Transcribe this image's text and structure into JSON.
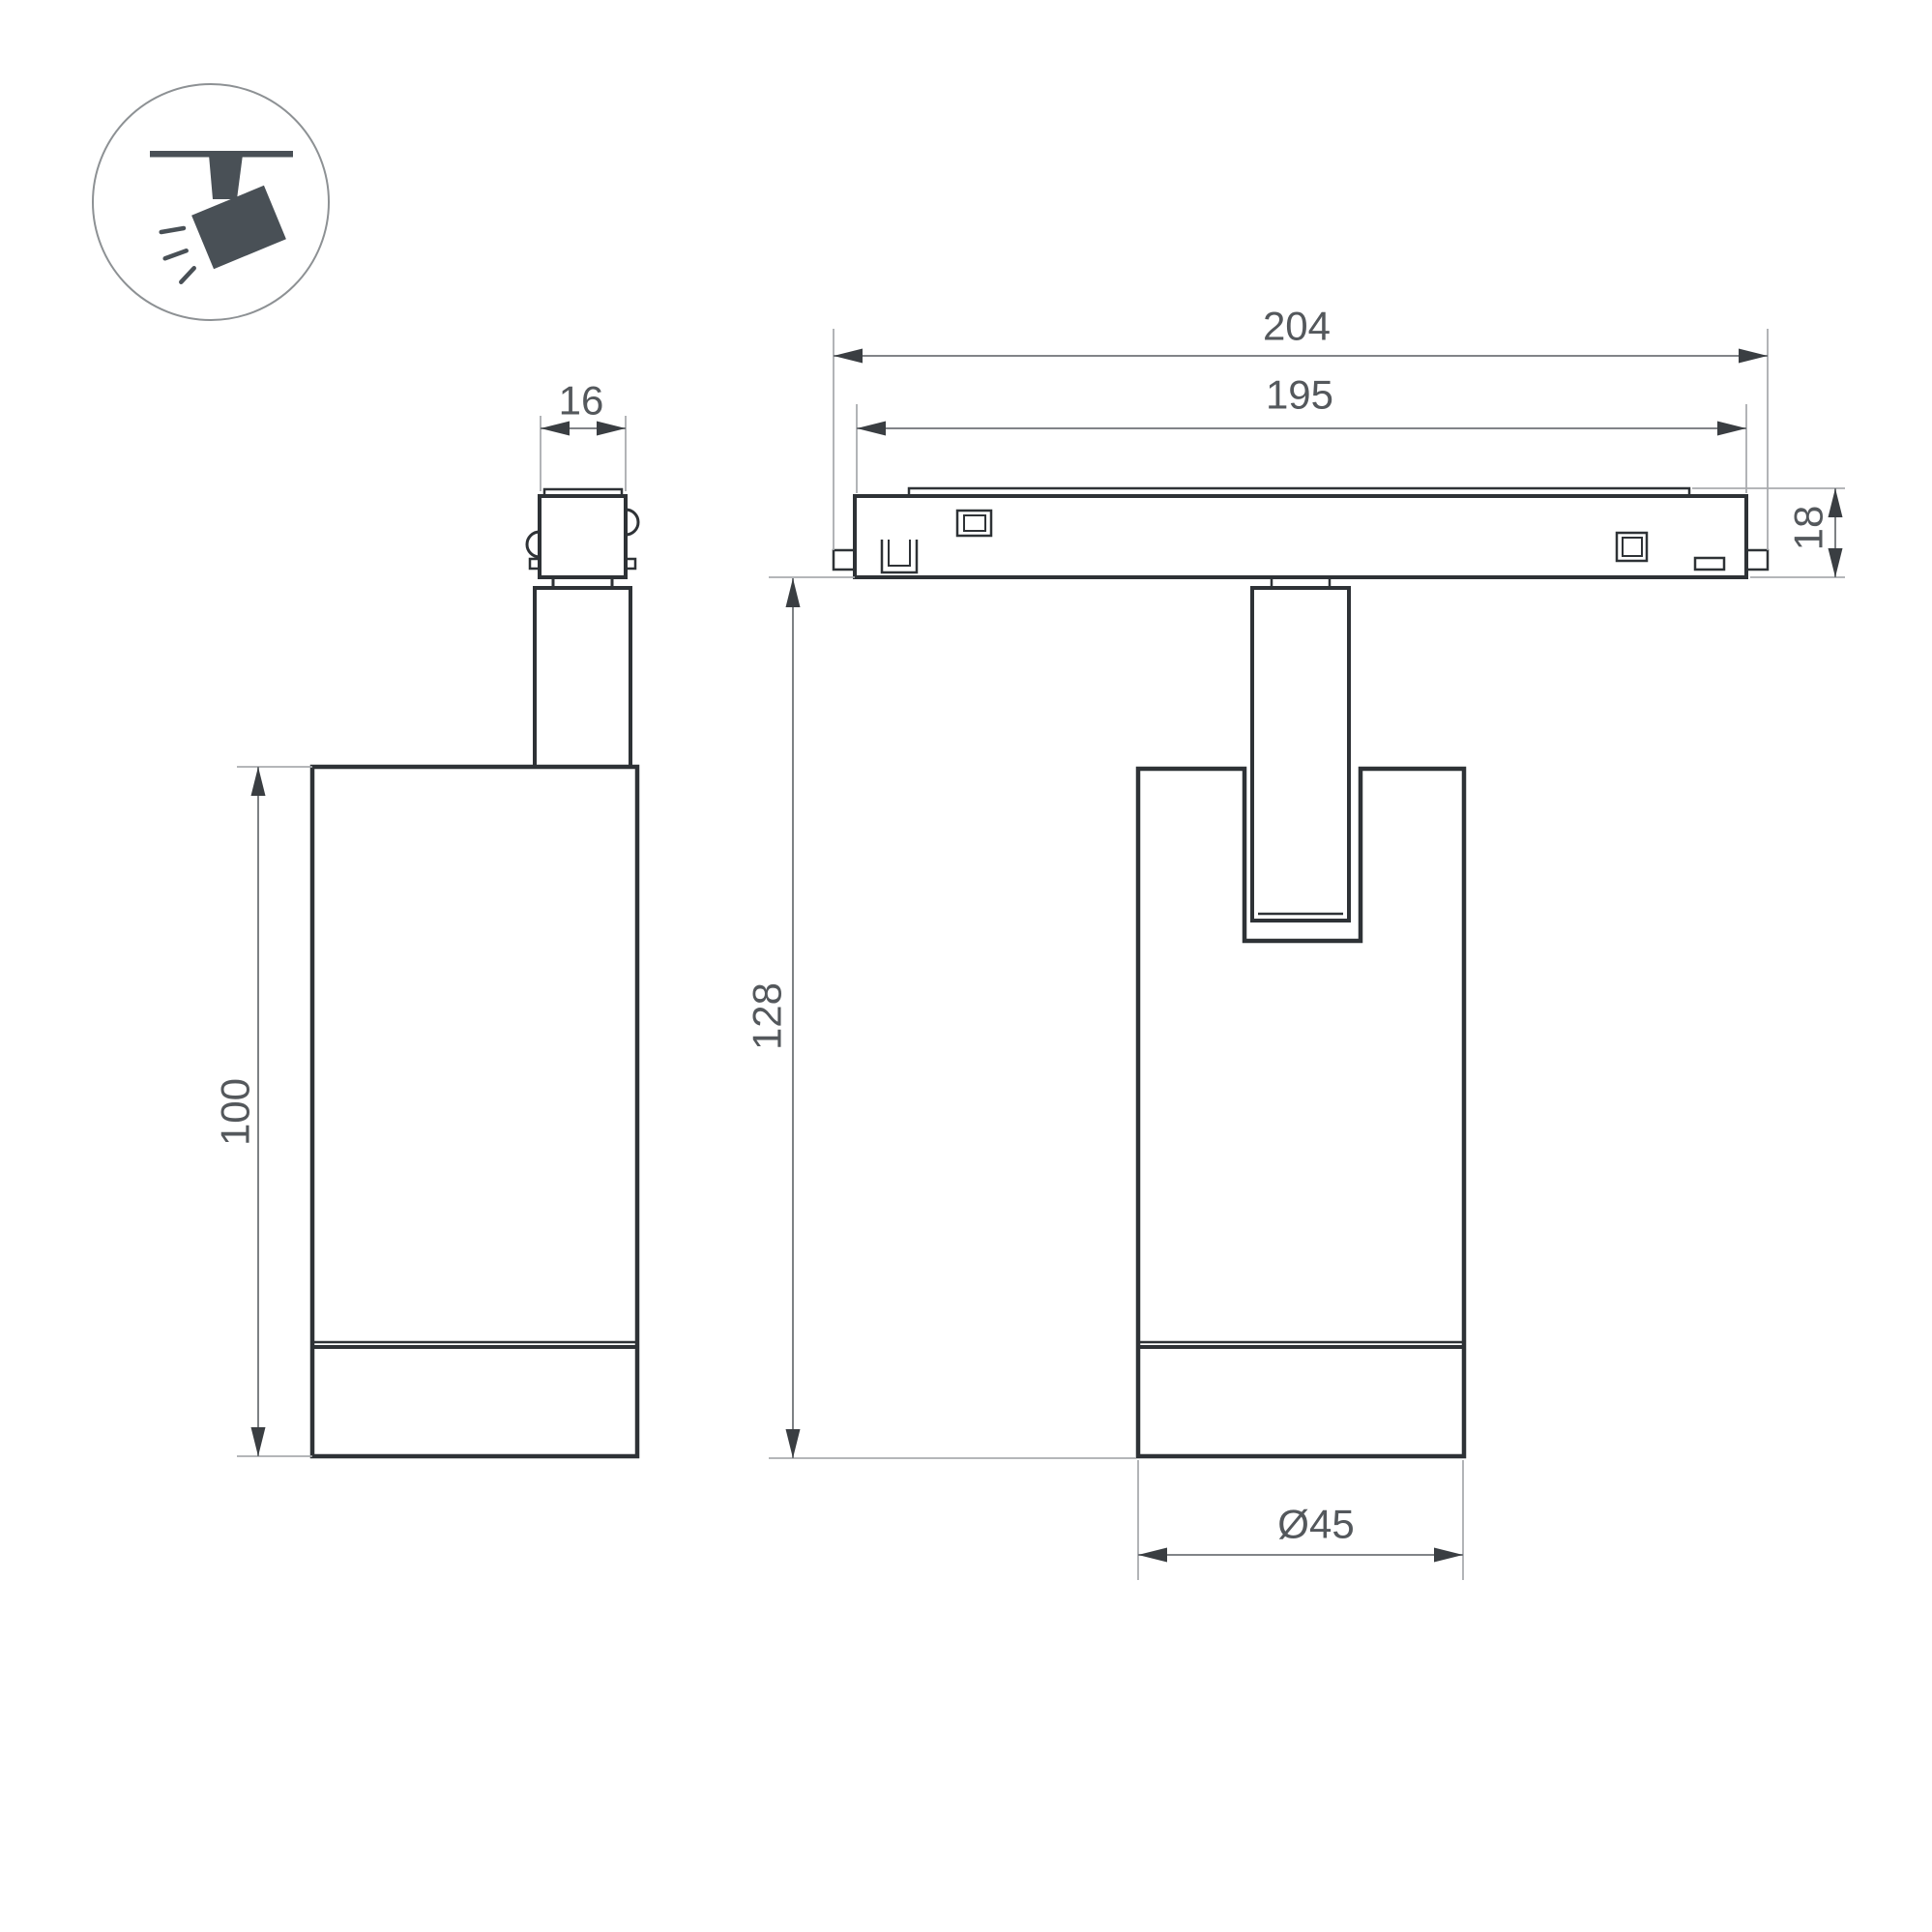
{
  "drawing": {
    "type": "technical-dimension-drawing",
    "subject": "magnetic track spotlight, two orthographic views with ceiling-track pictogram",
    "background": "#ffffff"
  },
  "colors": {
    "outline": "#2e3236",
    "dimension_line": "#6f7377",
    "extension_line": "#a9acaf",
    "arrow": "#3a3e42",
    "label_text": "#54585c",
    "icon_fill": "#495056",
    "icon_ring": "#8d9194"
  },
  "icon": {
    "name": "track-spotlight-icon",
    "description": "circled pictogram of a spotlight hanging from a track, tilted, emitting light rays"
  },
  "views": {
    "side_view": {
      "label": "side view of luminaire"
    },
    "front_view": {
      "label": "front view of luminaire on track"
    }
  },
  "dimensions": {
    "adapter_width": {
      "label": "16"
    },
    "body_height": {
      "label": "100"
    },
    "track_total_length": {
      "label": "204"
    },
    "track_inner_length": {
      "label": "195"
    },
    "track_height": {
      "label": "18"
    },
    "overall_height": {
      "label": "128"
    },
    "body_diameter": {
      "label": "Ø45"
    }
  }
}
